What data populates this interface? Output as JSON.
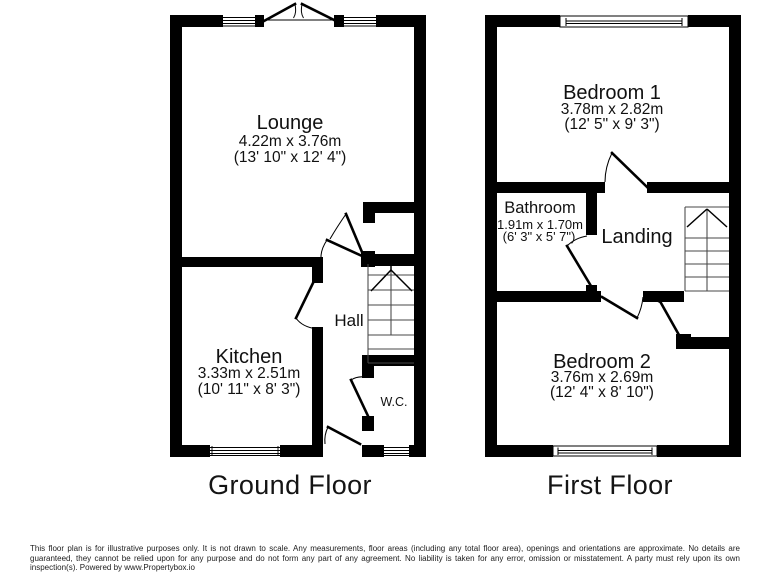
{
  "ground_floor": {
    "title": "Ground Floor",
    "rooms": {
      "lounge": {
        "name": "Lounge",
        "metric": "4.22m x 3.76m",
        "imperial": "(13' 10\" x 12' 4\")"
      },
      "kitchen": {
        "name": "Kitchen",
        "metric": "3.33m x 2.51m",
        "imperial": "(10' 11\" x 8' 3\")"
      },
      "hall": {
        "name": "Hall"
      },
      "wc": {
        "name": "W.C."
      }
    }
  },
  "first_floor": {
    "title": "First Floor",
    "rooms": {
      "bedroom1": {
        "name": "Bedroom 1",
        "metric": "3.78m x 2.82m",
        "imperial": "(12' 5\" x 9' 3\")"
      },
      "bathroom": {
        "name": "Bathroom",
        "metric": "1.91m x 1.70m",
        "imperial": "(6' 3\" x 5' 7\")"
      },
      "landing": {
        "name": "Landing"
      },
      "bedroom2": {
        "name": "Bedroom 2",
        "metric": "3.76m x 2.69m",
        "imperial": "(12' 4\" x 8' 10\")"
      }
    }
  },
  "colors": {
    "wall": "#000000",
    "stair_line": "#474747",
    "background": "#ffffff"
  },
  "disclaimer": "This floor plan is for illustrative purposes only. It is not drawn to scale. Any measurements, floor areas (including any total floor area), openings and orientations are approximate. No details are guaranteed, they cannot be relied upon for any purpose and do not form any part of any agreement. No liability is taken for any error, omission or misstatement. A party must rely upon its own inspection(s). Powered by www.Propertybox.io"
}
